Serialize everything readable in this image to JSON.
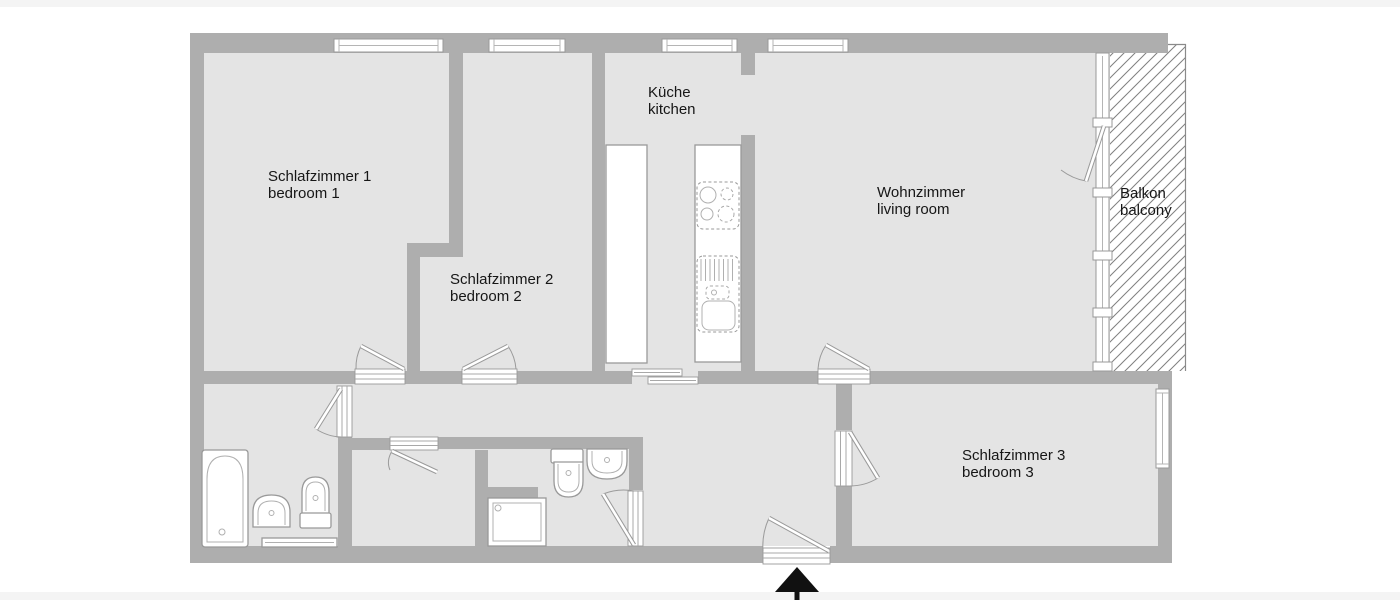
{
  "title": "apartment floor plan",
  "colors": {
    "wall": "#aeaeae",
    "floor": "#e4e4e4",
    "hatch_line": "#7f7f7f",
    "outline": "#999999",
    "arrow": "#111111",
    "text": "#161616"
  },
  "rooms": [
    {
      "id": "bedroom-1",
      "label_de": "Schlafzimmer 1",
      "label_en": "bedroom 1"
    },
    {
      "id": "bedroom-2",
      "label_de": "Schlafzimmer 2",
      "label_en": "bedroom  2"
    },
    {
      "id": "kitchen",
      "label_de": "Küche",
      "label_en": "kitchen"
    },
    {
      "id": "living-room",
      "label_de": "Wohnzimmer",
      "label_en": "living room"
    },
    {
      "id": "balcony",
      "label_de": "Balkon",
      "label_en": "balcony"
    },
    {
      "id": "bedroom-3",
      "label_de": "Schlafzimmer 3",
      "label_en": "bedroom 3"
    }
  ],
  "fixtures": [
    "bathtub",
    "washbasin",
    "toilet",
    "towel-radiator",
    "shower-tray",
    "toilet-2",
    "washbasin-2",
    "kitchen-counter",
    "kitchen-island",
    "stove-hob",
    "kitchen-sink"
  ],
  "entrance_marker": "entrance-arrow"
}
